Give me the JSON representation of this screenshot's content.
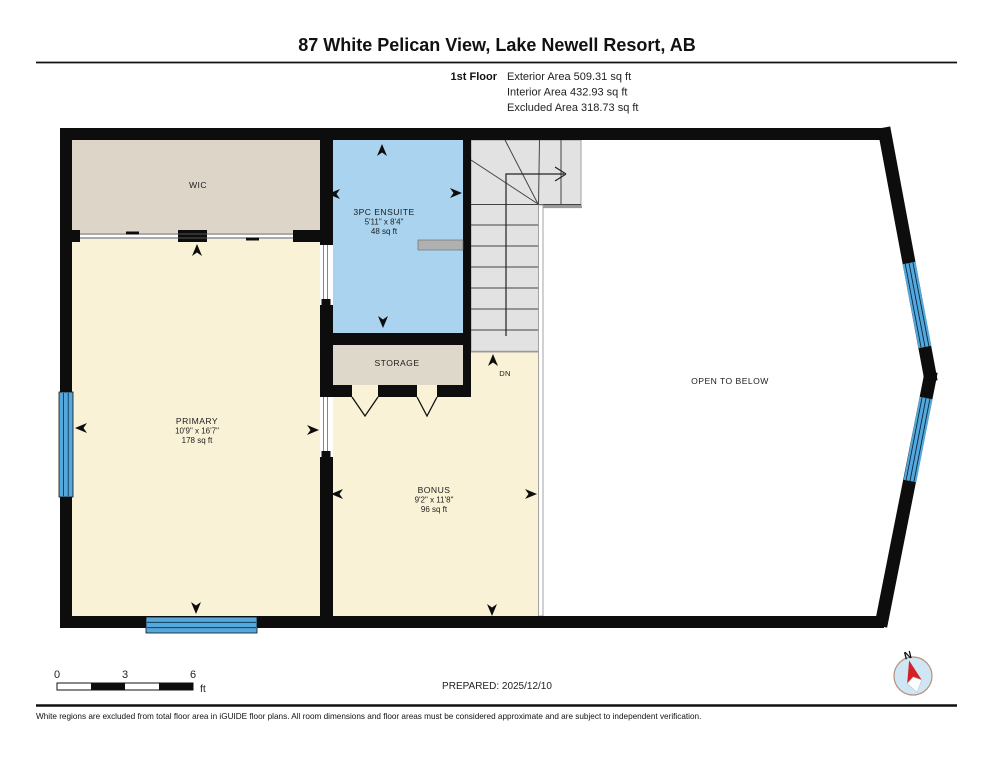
{
  "header": {
    "title": "87 White Pelican View, Lake Newell Resort, AB",
    "floor_label": "1st Floor",
    "area_lines": [
      "Exterior Area 509.31 sq ft",
      "Interior Area 432.93 sq ft",
      "Excluded Area 318.73 sq ft"
    ]
  },
  "rooms": {
    "wic": {
      "name": "WIC"
    },
    "ensuite": {
      "name": "3PC ENSUITE",
      "dims": "5'11\" x 8'4\"",
      "area": "48 sq ft"
    },
    "storage": {
      "name": "STORAGE"
    },
    "primary": {
      "name": "PRIMARY",
      "dims": "10'9\" x 16'7\"",
      "area": "178 sq ft"
    },
    "bonus": {
      "name": "BONUS",
      "dims": "9'2\" x 11'8\"",
      "area": "96 sq ft"
    },
    "open_below": {
      "name": "OPEN TO BELOW"
    },
    "stairs": {
      "label": "DN"
    }
  },
  "scale_bar": {
    "ticks": [
      "0",
      "3",
      "6"
    ],
    "unit": "ft"
  },
  "compass": {
    "label": "N"
  },
  "footer": {
    "prepared": "PREPARED: 2025/12/10",
    "disclaimer": "White regions are excluded from total floor area in iGUIDE floor plans. All room dimensions and floor areas must be considered approximate and are subject to independent verification."
  },
  "colors": {
    "wall": "#0d0d0d",
    "room_wic": "#ddd6c8",
    "room_ensuite": "#a9d3ee",
    "room_storage": "#ded8ca",
    "room_primary": "#faf2d7",
    "room_bonus": "#faf2d7",
    "stairs": "#e2e2e2",
    "window": "#55a8dc",
    "railing": "#999999",
    "door_line": "#777777",
    "compass_needle": "#d42127",
    "compass_face": "#cfe6f5"
  }
}
